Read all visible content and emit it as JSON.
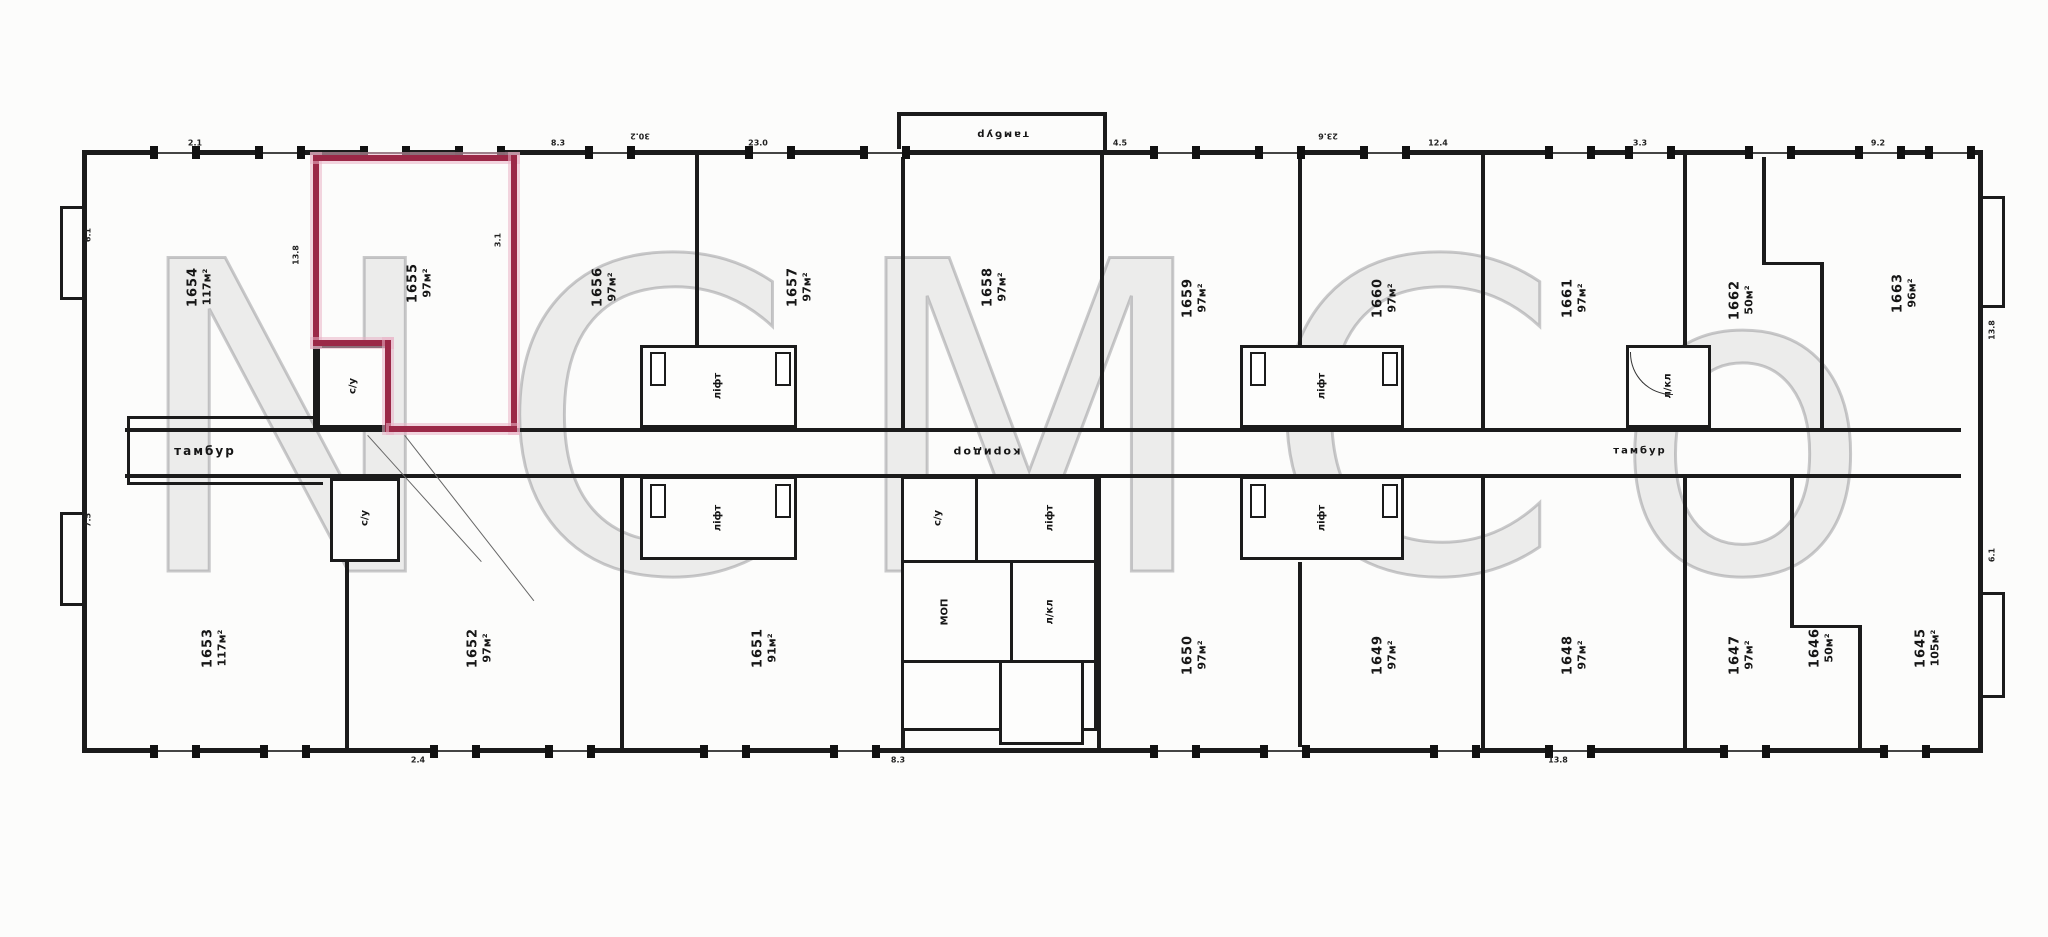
{
  "watermark": "NCMCo",
  "highlight_color": "#9b2847",
  "rooms": {
    "top": [
      {
        "number": "1654",
        "area": "117м²"
      },
      {
        "number": "1655",
        "area": "97м²",
        "highlighted": true
      },
      {
        "number": "1656",
        "area": "97м²"
      },
      {
        "number": "1657",
        "area": "97м²"
      },
      {
        "number": "1658",
        "area": "97м²"
      },
      {
        "number": "1659",
        "area": "97м²"
      },
      {
        "number": "1660",
        "area": "97м²"
      },
      {
        "number": "1661",
        "area": "97м²"
      },
      {
        "number": "1662",
        "area": "50м²"
      },
      {
        "number": "1663",
        "area": "96м²"
      }
    ],
    "bottom": [
      {
        "number": "1653",
        "area": "117м²"
      },
      {
        "number": "1652",
        "area": "97м²"
      },
      {
        "number": "1651",
        "area": "91м²"
      },
      {
        "number": "1650",
        "area": "97м²"
      },
      {
        "number": "1649",
        "area": "97м²"
      },
      {
        "number": "1648",
        "area": "97м²"
      },
      {
        "number": "1647",
        "area": "97м²"
      },
      {
        "number": "1646",
        "area": "50м²"
      },
      {
        "number": "1645",
        "area": "105м²"
      }
    ]
  },
  "labels": {
    "corridor": "коридор",
    "entry_top": "тамбур",
    "lobby_left": "тамбур",
    "lobby_right": "тамбур",
    "lift": "ліфт",
    "stair": "л/кл",
    "wc": "с/у",
    "service": "МОП"
  },
  "dims": [
    "6.1",
    "13.8",
    "3.1",
    "2.1",
    "8.3",
    "23.0",
    "4.5",
    "12.4",
    "3.3",
    "9.2",
    "7.5",
    "13.8",
    "6.1",
    "2.4",
    "8.3",
    "13.8",
    "30.2",
    "23.6"
  ]
}
